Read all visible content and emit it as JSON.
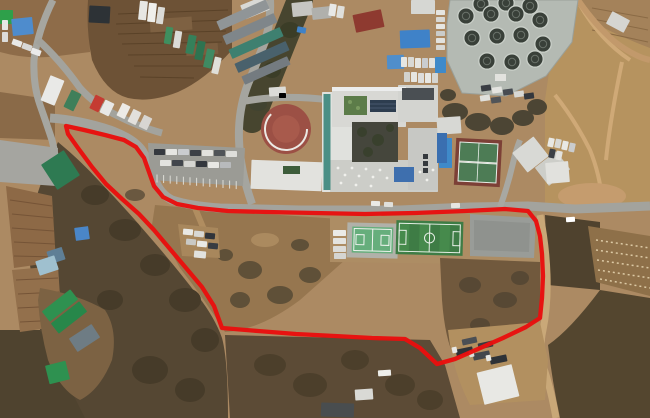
{
  "scene": {
    "width": 650,
    "height": 418,
    "type": "aerial-satellite-photo",
    "description": "Aerial photograph of a hillside school campus and surroundings with a red site-boundary outline drawn around a parcel containing wooded slope, sports fields and open ground"
  },
  "palette": {
    "boundary_red": "#e8100e",
    "road_gray": "#a3a39d",
    "dirt_road_tan": "#c9a878",
    "soil_tan": "#ac8a63",
    "woodland_dark": "#554733",
    "soccer_green": "#3e7c45",
    "court_light_green": "#66ae7c",
    "tennis_clay": "#7c4036",
    "roof_blue": "#3f82c8",
    "roof_green": "#2e9150",
    "roof_red": "#8e3a30"
  },
  "boundary": {
    "color": "#e8100e",
    "width": 4.3,
    "points": [
      [
        66,
        126
      ],
      [
        84,
        130
      ],
      [
        105,
        135
      ],
      [
        124,
        140
      ],
      [
        136,
        147
      ],
      [
        144,
        158
      ],
      [
        149,
        172
      ],
      [
        154,
        186
      ],
      [
        163,
        197
      ],
      [
        177,
        204
      ],
      [
        198,
        208
      ],
      [
        228,
        211
      ],
      [
        268,
        212
      ],
      [
        315,
        213
      ],
      [
        365,
        214
      ],
      [
        415,
        213
      ],
      [
        465,
        211
      ],
      [
        505,
        209
      ],
      [
        528,
        211
      ],
      [
        536,
        221
      ],
      [
        540,
        236
      ],
      [
        542,
        254
      ],
      [
        543,
        276
      ],
      [
        542,
        298
      ],
      [
        540,
        318
      ],
      [
        526,
        327
      ],
      [
        503,
        338
      ],
      [
        478,
        349
      ],
      [
        455,
        359
      ],
      [
        437,
        364
      ],
      [
        420,
        348
      ],
      [
        405,
        339
      ],
      [
        372,
        338
      ],
      [
        335,
        336
      ],
      [
        296,
        334
      ],
      [
        258,
        331
      ],
      [
        222,
        328
      ],
      [
        214,
        306
      ],
      [
        202,
        287
      ],
      [
        186,
        268
      ],
      [
        170,
        249
      ],
      [
        154,
        230
      ],
      [
        139,
        214
      ],
      [
        122,
        199
      ],
      [
        106,
        184
      ],
      [
        92,
        167
      ],
      [
        78,
        148
      ],
      [
        68,
        134
      ]
    ]
  },
  "tank_facility": {
    "name": "circular-tank-facility",
    "platform": [
      [
        450,
        0
      ],
      [
        578,
        0
      ],
      [
        572,
        42
      ],
      [
        546,
        76
      ],
      [
        506,
        96
      ],
      [
        462,
        93
      ],
      [
        447,
        60
      ],
      [
        447,
        24
      ]
    ],
    "platform_fill": "#b4bab3",
    "tank_fill": "#394039",
    "tank_rim": "#c9cfc8",
    "tank_inner": "#6a726a",
    "r": 8.2,
    "tanks": [
      [
        481,
        4
      ],
      [
        506,
        3
      ],
      [
        530,
        6
      ],
      [
        466,
        16
      ],
      [
        491,
        14
      ],
      [
        516,
        14
      ],
      [
        540,
        20
      ],
      [
        472,
        38
      ],
      [
        497,
        36
      ],
      [
        521,
        35
      ],
      [
        543,
        44
      ],
      [
        487,
        61
      ],
      [
        512,
        62
      ],
      [
        535,
        59
      ]
    ]
  },
  "buildings": [
    [
      "green-shed-nw",
      0,
      10,
      13,
      14,
      0,
      "#2ea04a"
    ],
    [
      "blue-roof-bldg-nw",
      12,
      18,
      21,
      17,
      -6,
      "#4e8ccd"
    ],
    [
      "dark-barn-n",
      89,
      6,
      21,
      17,
      3,
      "#2d3236"
    ],
    [
      "white-shed-n",
      242,
      0,
      26,
      15,
      -22,
      "#d9d9d5"
    ],
    [
      "warehouse-1",
      216,
      10,
      54,
      10,
      -24,
      "#909597"
    ],
    [
      "warehouse-2",
      222,
      24,
      56,
      10,
      -24,
      "#7f868a"
    ],
    [
      "warehouse-3",
      228,
      38,
      56,
      10,
      -24,
      "#3e8070"
    ],
    [
      "warehouse-4",
      234,
      52,
      56,
      10,
      -24,
      "#49616c"
    ],
    [
      "warehouse-5",
      241,
      66,
      50,
      9,
      -24,
      "#747b80"
    ],
    [
      "gray-bldg-n1",
      292,
      2,
      21,
      14,
      -6,
      "#c6c6c2"
    ],
    [
      "gray-bldg-n2",
      312,
      7,
      19,
      12,
      -6,
      "#b0b0ac"
    ],
    [
      "red-roof-bldg",
      354,
      12,
      29,
      18,
      -12,
      "#8e3a30"
    ],
    [
      "blue-roof-bldg-1",
      400,
      30,
      30,
      18,
      -2,
      "#3f82c8"
    ],
    [
      "blue-roof-bldg-2",
      387,
      55,
      17,
      14,
      -2,
      "#4f8ecb"
    ],
    [
      "white-bldg-ne",
      411,
      0,
      24,
      14,
      0,
      "#d6d7d3"
    ],
    [
      "white-bldg-far-ne",
      608,
      15,
      20,
      14,
      28,
      "#d5d5d1"
    ],
    [
      "school-west-wing",
      322,
      92,
      31,
      100,
      0,
      "#e0e1dd"
    ],
    [
      "school-north-wing",
      332,
      87,
      74,
      40,
      0,
      "#d8d8d4"
    ],
    [
      "school-ne-wing",
      398,
      85,
      40,
      37,
      0,
      "#d3d4d0"
    ],
    [
      "school-south-wing",
      330,
      160,
      108,
      32,
      0,
      "#cccdc8"
    ],
    [
      "school-east-annex",
      408,
      128,
      30,
      62,
      0,
      "#c7c8c4"
    ],
    [
      "school-west-building",
      251,
      161,
      71,
      29,
      2,
      "#e2e2de"
    ],
    [
      "playground-shed",
      269,
      87,
      17,
      9,
      -4,
      "#dcdcd8"
    ],
    [
      "greenhouse-west",
      47,
      155,
      27,
      30,
      -33,
      "#2e7a52"
    ],
    [
      "white-bldg-e1",
      517,
      142,
      27,
      25,
      -38,
      "#d8d9d5"
    ],
    [
      "white-bldg-e2",
      539,
      157,
      27,
      23,
      -38,
      "#cdcec9"
    ],
    [
      "white-bldg-e3",
      546,
      162,
      23,
      21,
      -5,
      "#e1e1dd"
    ],
    [
      "white-bldg-tennis-n",
      437,
      117,
      24,
      17,
      -4,
      "#d7d8d4"
    ],
    [
      "farm-greenroof-1",
      42,
      299,
      36,
      13,
      -38,
      "#2e9150"
    ],
    [
      "farm-greenroof-2",
      51,
      311,
      36,
      13,
      -38,
      "#27874a"
    ],
    [
      "farm-shed",
      71,
      330,
      27,
      16,
      -33,
      "#6e7c84"
    ],
    [
      "farm-greenroof-3",
      47,
      363,
      21,
      19,
      -14,
      "#2e9150"
    ],
    [
      "blue-hut-1",
      75,
      227,
      14,
      13,
      -8,
      "#4a86c8"
    ],
    [
      "blue-hut-2",
      48,
      249,
      16,
      13,
      -18,
      "#5f7f96"
    ],
    [
      "greenhouse-sw",
      37,
      258,
      20,
      15,
      -18,
      "#9fc0cf"
    ],
    [
      "se-yard-shed",
      480,
      368,
      36,
      33,
      -14,
      "#e8e8e4"
    ],
    [
      "south-shed-1",
      321,
      403,
      33,
      14,
      2,
      "#494d4f"
    ],
    [
      "south-shed-2",
      355,
      389,
      18,
      11,
      -4,
      "#d9d9d5"
    ],
    [
      "blue-pool-e",
      439,
      138,
      13,
      30,
      0,
      "#3f8ac9"
    ],
    [
      "blue-pool-tanks",
      435,
      57,
      11,
      16,
      0,
      "#3f8ac9"
    ]
  ],
  "courts": {
    "soccer": {
      "name": "soccer-field",
      "x": 396,
      "y": 221,
      "w": 67,
      "h": 34,
      "rot": 1.5,
      "fill": "#3e7c45",
      "stripe": "#468a4c",
      "line": "#e9f0e8"
    },
    "multi": {
      "name": "multi-sport-court",
      "x": 352,
      "y": 227,
      "w": 41,
      "h": 26,
      "rot": 1.5,
      "fill": "#66ae7c",
      "apron": "#b1b1a9",
      "line": "#eef3ee"
    },
    "tennis": {
      "name": "tennis-court",
      "x": 455,
      "y": 139,
      "w": 46,
      "h": 47,
      "rot": 3,
      "fill": "#7c4036",
      "court": "#4d7c55",
      "line": "#e9efe9"
    }
  },
  "playground": {
    "name": "round-playground",
    "cx": 286,
    "cy": 129,
    "r": 25,
    "fill": "#9c5045",
    "inner": "#a85a4c",
    "arc_color": "#ece9e4",
    "arc_r": 21,
    "arc_start": 0,
    "arc_end": 225,
    "equip": [
      279,
      93,
      7,
      5,
      "#4a86c8"
    ]
  },
  "vehicle_groups": [
    {
      "name": "parked-trucks-nw",
      "items": [
        [
          139,
          1,
          8,
          19,
          6,
          "#e7e7e3"
        ],
        [
          148,
          3,
          8,
          19,
          6,
          "#efefeb"
        ],
        [
          157,
          7,
          7,
          17,
          8,
          "#dbdbd7"
        ],
        [
          165,
          27,
          7,
          17,
          9,
          "#3f8f5f"
        ],
        [
          174,
          31,
          7,
          17,
          9,
          "#dcdcd8"
        ],
        [
          187,
          35,
          8,
          19,
          11,
          "#35805a"
        ],
        [
          196,
          41,
          8,
          19,
          11,
          "#2e7350"
        ],
        [
          205,
          49,
          8,
          19,
          13,
          "#3f8a62"
        ],
        [
          213,
          57,
          7,
          17,
          13,
          "#dfdfd9"
        ]
      ]
    },
    {
      "name": "vehicles-on-west-road",
      "items": [
        [
          45,
          77,
          15,
          27,
          22,
          "#e9e9e7"
        ],
        [
          67,
          91,
          11,
          19,
          26,
          "#3f7f5a"
        ],
        [
          92,
          96,
          10,
          15,
          26,
          "#c53b32"
        ],
        [
          102,
          101,
          10,
          14,
          26,
          "#e8e8e6"
        ],
        [
          119,
          104,
          9,
          14,
          26,
          "#eceae6"
        ],
        [
          130,
          110,
          9,
          14,
          26,
          "#e2e0dc"
        ],
        [
          141,
          116,
          9,
          13,
          26,
          "#d8d6d2"
        ]
      ]
    },
    {
      "name": "cars-nw-corner",
      "items": [
        [
          2,
          20,
          6,
          10,
          0,
          "#e8e8e6"
        ],
        [
          2,
          32,
          6,
          10,
          0,
          "#dcdcda"
        ],
        [
          12,
          40,
          10,
          6,
          20,
          "#e8e8e6"
        ],
        [
          22,
          44,
          10,
          6,
          20,
          "#d8d8d6"
        ],
        [
          31,
          49,
          10,
          6,
          20,
          "#eaeaea"
        ]
      ]
    },
    {
      "name": "campus-parking-cars",
      "items": [
        [
          154,
          149,
          11,
          6,
          0,
          "#35393f"
        ],
        [
          166,
          149,
          11,
          6,
          0,
          "#e6e6e2"
        ],
        [
          178,
          149,
          11,
          6,
          0,
          "#caccce"
        ],
        [
          190,
          150,
          11,
          6,
          0,
          "#3c4046"
        ],
        [
          202,
          150,
          11,
          6,
          0,
          "#e2e2de"
        ],
        [
          214,
          150,
          11,
          6,
          0,
          "#505458"
        ],
        [
          226,
          151,
          11,
          6,
          0,
          "#dededa"
        ],
        [
          160,
          160,
          11,
          6,
          0,
          "#e4e4e0"
        ],
        [
          172,
          160,
          11,
          6,
          0,
          "#42464c"
        ],
        [
          184,
          161,
          11,
          6,
          0,
          "#d6d6d2"
        ],
        [
          196,
          161,
          11,
          6,
          0,
          "#34383e"
        ],
        [
          208,
          162,
          11,
          6,
          0,
          "#e8e8e4"
        ],
        [
          220,
          162,
          11,
          6,
          0,
          "#b8babc"
        ]
      ]
    },
    {
      "name": "cars-north-lot",
      "items": [
        [
          401,
          57,
          6,
          10,
          0,
          "#e6e6e2"
        ],
        [
          408,
          57,
          6,
          10,
          0,
          "#d9d9d5"
        ],
        [
          415,
          58,
          6,
          10,
          0,
          "#e6e6e2"
        ],
        [
          422,
          58,
          6,
          10,
          0,
          "#caccce"
        ],
        [
          429,
          58,
          6,
          10,
          0,
          "#e2e2de"
        ],
        [
          404,
          72,
          6,
          10,
          0,
          "#d2d2ce"
        ],
        [
          411,
          72,
          6,
          10,
          0,
          "#e6e6e2"
        ],
        [
          418,
          73,
          6,
          10,
          0,
          "#dddddb"
        ],
        [
          425,
          73,
          6,
          10,
          0,
          "#e8e8e4"
        ],
        [
          432,
          73,
          6,
          10,
          0,
          "#d5d5d1"
        ]
      ]
    },
    {
      "name": "cars-tank-facility-west",
      "items": [
        [
          436,
          10,
          9,
          5,
          0,
          "#e4e4e0"
        ],
        [
          436,
          17,
          9,
          5,
          0,
          "#d8d8d4"
        ],
        [
          436,
          24,
          9,
          5,
          0,
          "#e6e6e2"
        ],
        [
          436,
          31,
          9,
          5,
          0,
          "#caccca"
        ],
        [
          436,
          38,
          9,
          5,
          0,
          "#e2e2de"
        ],
        [
          436,
          45,
          9,
          5,
          0,
          "#d8d8d4"
        ]
      ]
    },
    {
      "name": "cars-tank-facility-south",
      "items": [
        [
          481,
          85,
          10,
          6,
          -8,
          "#3a3e44"
        ],
        [
          492,
          87,
          10,
          6,
          -8,
          "#e4e4e0"
        ],
        [
          503,
          89,
          10,
          6,
          -8,
          "#474b51"
        ],
        [
          514,
          91,
          10,
          6,
          -8,
          "#d8d8d4"
        ],
        [
          524,
          93,
          10,
          6,
          -8,
          "#33373d"
        ],
        [
          480,
          95,
          10,
          6,
          -8,
          "#e0e0dc"
        ],
        [
          491,
          97,
          10,
          6,
          -8,
          "#505458"
        ]
      ]
    },
    {
      "name": "cars-east-buildings",
      "items": [
        [
          548,
          138,
          6,
          9,
          12,
          "#e8e8e4"
        ],
        [
          555,
          139,
          6,
          9,
          12,
          "#d9d9d5"
        ],
        [
          562,
          141,
          6,
          9,
          12,
          "#e8e8e4"
        ],
        [
          549,
          149,
          6,
          9,
          12,
          "#3c4046"
        ],
        [
          556,
          151,
          6,
          9,
          12,
          "#e2e2de"
        ],
        [
          569,
          143,
          6,
          9,
          12,
          "#caccce"
        ]
      ]
    },
    {
      "name": "cars-dirt-lot",
      "items": [
        [
          183,
          229,
          10,
          6,
          5,
          "#e9e9e5"
        ],
        [
          194,
          231,
          10,
          6,
          5,
          "#d8d8d4"
        ],
        [
          205,
          233,
          10,
          6,
          5,
          "#30343a"
        ],
        [
          186,
          239,
          10,
          6,
          5,
          "#c9c9c5"
        ],
        [
          197,
          241,
          10,
          6,
          5,
          "#e9e9e5"
        ],
        [
          208,
          243,
          10,
          6,
          5,
          "#383c42"
        ],
        [
          194,
          251,
          12,
          7,
          5,
          "#e2e2de"
        ]
      ]
    },
    {
      "name": "cars-by-courts",
      "items": [
        [
          333,
          230,
          13,
          6,
          0,
          "#ebebe7"
        ],
        [
          333,
          238,
          13,
          6,
          0,
          "#e4e4e0"
        ],
        [
          333,
          246,
          13,
          6,
          0,
          "#dcdcd8"
        ],
        [
          334,
          253,
          12,
          6,
          0,
          "#d5d5d1"
        ],
        [
          371,
          201,
          9,
          5,
          2,
          "#eaeae6"
        ],
        [
          384,
          202,
          9,
          5,
          2,
          "#e0e0dc"
        ],
        [
          451,
          203,
          9,
          5,
          -2,
          "#e6e6e2"
        ]
      ]
    },
    {
      "name": "trucks-se-yard",
      "items": [
        [
          456,
          348,
          17,
          7,
          -12,
          "#2e3237"
        ],
        [
          473,
          352,
          17,
          7,
          -12,
          "#43474c"
        ],
        [
          490,
          356,
          17,
          7,
          -12,
          "#2e3237"
        ],
        [
          462,
          338,
          15,
          6,
          -12,
          "#4b4f54"
        ],
        [
          478,
          342,
          15,
          6,
          -12,
          "#36393f"
        ],
        [
          452,
          347,
          5,
          6,
          -12,
          "#e8e8e4"
        ],
        [
          469,
          351,
          5,
          6,
          -12,
          "#dfdfdb"
        ],
        [
          486,
          355,
          5,
          6,
          -12,
          "#e8e8e4"
        ]
      ]
    },
    {
      "name": "misc-vehicles",
      "items": [
        [
          566,
          217,
          9,
          5,
          -3,
          "#ffffff"
        ],
        [
          378,
          370,
          13,
          6,
          -4,
          "#eeeeea"
        ],
        [
          297,
          27,
          9,
          6,
          10,
          "#3f82c8"
        ],
        [
          329,
          4,
          7,
          12,
          8,
          "#e8e8e6"
        ],
        [
          337,
          6,
          7,
          12,
          8,
          "#dfdfdb"
        ]
      ]
    }
  ],
  "parking_stripes": {
    "x": 157,
    "y": 174.5,
    "n": 13,
    "dx": 6.6,
    "dy": 0.55,
    "len": 8,
    "color": "#dcdcd6"
  }
}
